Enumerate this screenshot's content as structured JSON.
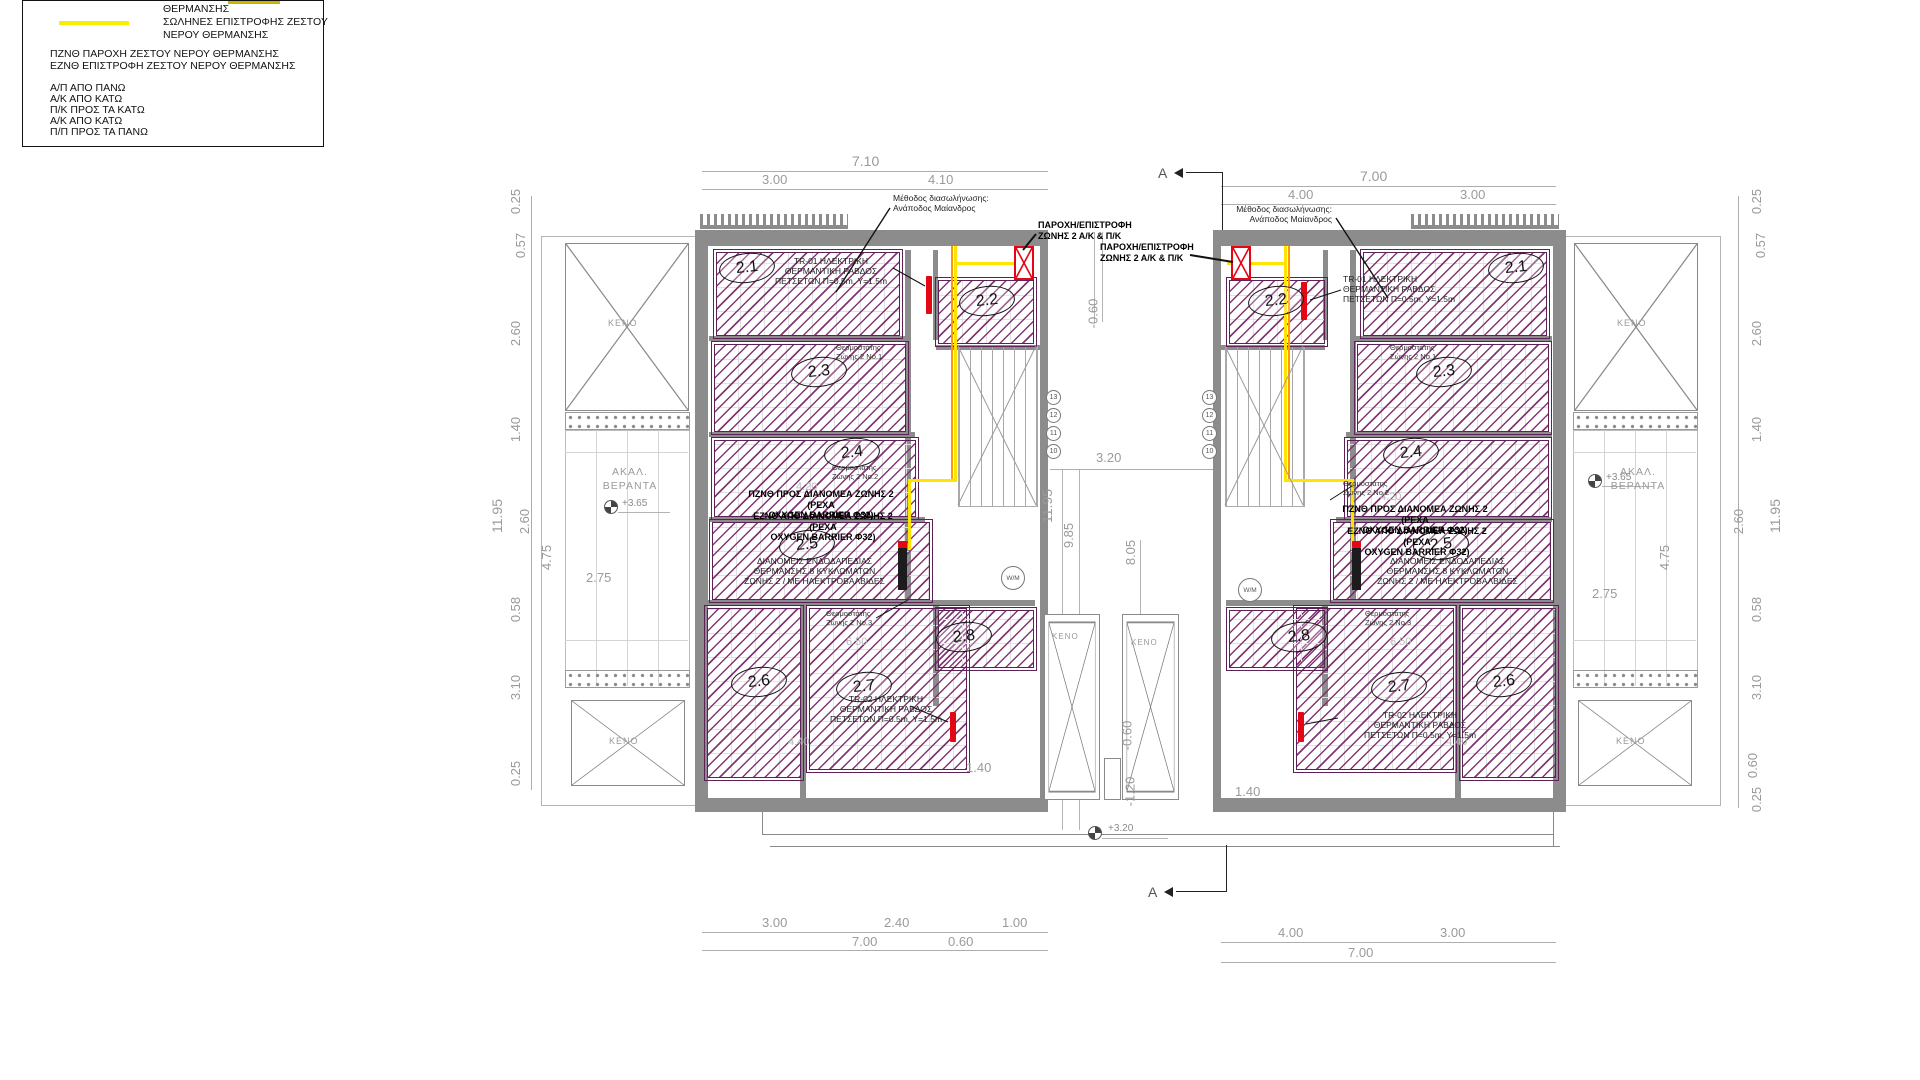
{
  "legend": {
    "row1_label": "ΘΕΡΜΑΝΣΗΣ",
    "row2_label_l1": "ΣΩΛΗΝΕΣ ΕΠΙΣΤΡΟΦΗΣ ΖΕΣΤΟΥ",
    "row2_label_l2": "ΝΕΡΟΥ ΘΕΡΜΑΝΣΗΣ",
    "abbr1": "ΠΖΝΘ ΠΑΡΟΧΗ ΖΕΣΤΟΥ ΝΕΡΟΥ ΘΕΡΜΑΝΣΗΣ",
    "abbr2": "ΕΖΝΘ ΕΠΙΣΤΡΟΦΗ ΖΕΣΤΟΥ ΝΕΡΟΥ ΘΕΡΜΑΝΣΗΣ",
    "dir1": "Α/Π ΑΠΟ ΠΑΝΩ",
    "dir2": "Α/Κ ΑΠΟ ΚΑΤΩ",
    "dir3": "Π/Κ ΠΡΟΣ ΤΑ ΚΑΤΩ",
    "dir4": "Α/Κ ΑΠΟ ΚΑΤΩ",
    "dir5": "Π/Π ΠΡΟΣ ΤΑ ΠΑΝΩ",
    "colors": {
      "return_pipe": "#f7ef00",
      "supply_pipe": "#ff9900",
      "heating_circuit": "#7b2d6e",
      "equipment_red": "#e30613"
    }
  },
  "rooms": {
    "r21": "2.1",
    "r22": "2.2",
    "r23": "2.3",
    "r24": "2.4",
    "r25": "2.5",
    "r26": "2.6",
    "r27": "2.7",
    "r28": "2.8"
  },
  "labels": {
    "keno": "ΚΕΝΟ",
    "balcony_l1": "ΑΚΑΛ.",
    "balcony_l2": "ΒΕΡΑΝΤΑ",
    "section": "A",
    "wm": "W/M"
  },
  "annotations": {
    "method_l1": "Μέθοδος διασωλήνωσης:",
    "method_l2": "Ανάποδος Μαίανδρος",
    "supply_return_l1": "ΠΑΡΟΧΗ/ΕΠΙΣΤΡΟΦΗ",
    "supply_return_l2": "ΖΩΝΗΣ 2 Α/Κ & Π/Κ",
    "tr01_l1": "TR-01 ΗΛΕΚΤΡΙΚΗ",
    "tr01_l2": "ΘΕΡΜΑΝΤΙΚΗ ΡΑΒΔΟΣ",
    "tr01_l3": "ΠΕΤΣΕΤΩΝ Π=0.5m, Υ=1.5m",
    "tr02_l1": "TR-02 ΗΛΕΚΤΡΙΚΗ",
    "tr02_l2": "ΘΕΡΜΑΝΤΙΚΗ ΡΑΒΔΟΣ",
    "tr02_l3": "ΠΕΤΣΕΤΩΝ Π=0.5m, Υ=1.5m",
    "pznth_l1": "ΠΖΝΘ ΠΡΟΣ ΔΙΑΝΟΜΕΑ ΖΩΝΗΣ 2 (PEXA",
    "pznth_l2": "OXYGEN BARRIER Φ32)",
    "eznth_l1": "ΕΖΝΘ ΑΠΟ ΔΙΑΝΟΜΕΑ ΖΩΝΗΣ 2 (PEXA",
    "eznth_l2": "OXYGEN BARRIER Φ32)",
    "manifold_l1": "ΔΙΑΝΟΜΕΙΣ ΕΝΔΟΔΑΠΕΔΙΑΣ",
    "manifold_l2": "ΘΕΡΜΑΝΣΗΣ 8 ΚΥΚΛΩΜΑΤΩΝ",
    "manifold_l3": "ΖΩΝΗΣ 2 / ΜΕ ΗΛΕΚΤΡΟΒΑΛΒΙΔΕΣ",
    "thermo": "Θερμοστάτης",
    "thermo_no1": "Ζώνης 2 Νο.1",
    "thermo_no2": "Ζώνης 2 Νο.2",
    "thermo_no3": "Ζώνης 2 Νο.3"
  },
  "stairs": {
    "n13": "13",
    "n12": "12",
    "n11": "11",
    "n10": "10"
  },
  "dims": {
    "v710": "7.10",
    "v300": "3.00",
    "v410": "4.10",
    "v700": "7.00",
    "v400": "4.00",
    "v240": "2.40",
    "v060": "0.60",
    "v100": "1.00",
    "v025": "0.25",
    "v057": "0.57",
    "v260": "2.60",
    "v140": "1.40",
    "v1195": "11.95",
    "v475": "4.75",
    "v275": "2.75",
    "v058": "0.58",
    "v310": "3.10",
    "v320": "3.20",
    "v985": "9.85",
    "v805": "8.05",
    "vm060": "-0.60",
    "vm120": "-1.20",
    "v420": "4.20",
    "v650": "6.50",
    "v440": "4.40"
  },
  "elev": {
    "p365": "+3.65",
    "p320": "+3.20"
  }
}
